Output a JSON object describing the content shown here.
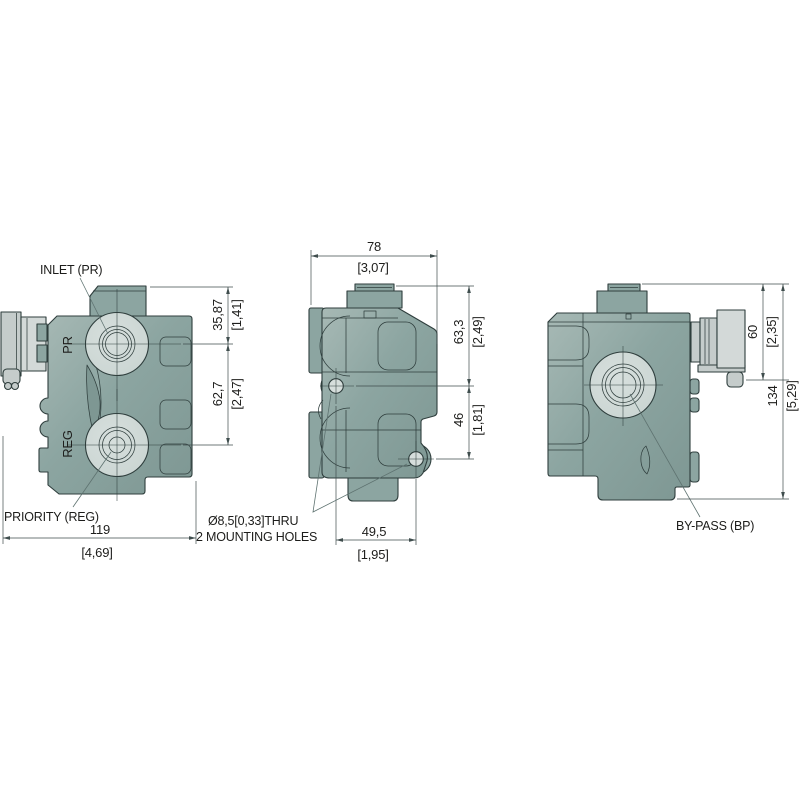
{
  "views": {
    "side_left": {
      "label_inlet": "INLET (PR)",
      "label_priority": "PRIORITY (REG)",
      "port_pr": "PR",
      "port_reg": "REG",
      "dim_inlet_mm": "35,87",
      "dim_inlet_in": "[1,41]",
      "dim_spacing_mm": "62,7",
      "dim_spacing_in": "[2,47]",
      "dim_width_mm": "119",
      "dim_width_in": "[4,69]"
    },
    "front": {
      "dim_width_mm": "78",
      "dim_width_in": "[3,07]",
      "dim_upper_mm": "63,3",
      "dim_upper_in": "[2,49]",
      "dim_lower_mm": "46",
      "dim_lower_in": "[1,81]",
      "dim_holes_mm": "49,5",
      "dim_holes_in": "[1,95]",
      "note_holes_line1": "Ø8,5[0,33]THRU",
      "note_holes_line2": "2 MOUNTING HOLES"
    },
    "side_right": {
      "label_bypass": "BY-PASS (BP)",
      "dim_connector_mm": "60",
      "dim_connector_in": "[2,35]",
      "dim_overall_mm": "134",
      "dim_overall_in": "[5,29]"
    }
  },
  "colors": {
    "background": "#FFFFFF",
    "body": "#8CA5A1",
    "body_light": "#A7B9B5",
    "body_dark": "#7E9793",
    "boss": "#CAD5D2",
    "boss_light": "#D7DFDD",
    "hole": "#D6DEDC",
    "connector": "#C5CCCB",
    "connector_light": "#D3D9D8",
    "outline": "#2F3E3D",
    "dim_line": "#3F4D4D",
    "leader": "#5E7270",
    "text": "#1D1D1B"
  }
}
